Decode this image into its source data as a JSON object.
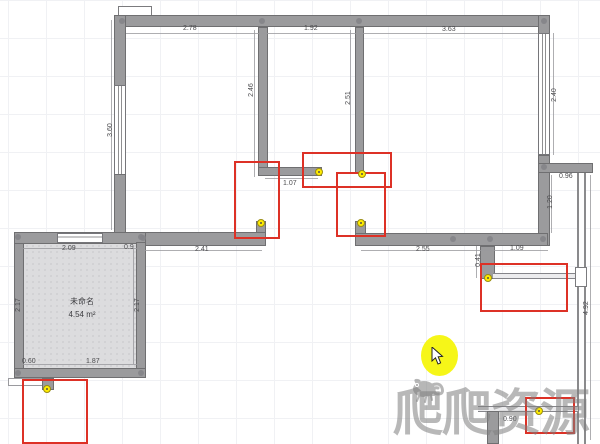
{
  "app": {
    "type": "floorplan-editor"
  },
  "room": {
    "name": "未命名",
    "area": "4.54 m²"
  },
  "watermark": {
    "text": "爬爬资源"
  },
  "colors": {
    "wall": "#9b9b9d",
    "highlight_red": "#dd3126",
    "endpoint_yellow": "#ffec00",
    "cursor_highlight": "#f6f618",
    "watermark_gray": "#7d7d7d"
  },
  "dimensions": [
    {
      "id": "top-left-span",
      "text": "2.78"
    },
    {
      "id": "top-mid-span",
      "text": "1.92"
    },
    {
      "id": "top-right-span",
      "text": "3.63"
    },
    {
      "id": "left-wall-window",
      "text": "3.60"
    },
    {
      "id": "interior-wall-1",
      "text": "2.46"
    },
    {
      "id": "interior-wall-2",
      "text": "2.51"
    },
    {
      "id": "right-wall-window",
      "text": "2.40"
    },
    {
      "id": "right-opening",
      "text": "0.96"
    },
    {
      "id": "right-inner-wall",
      "text": "1.20"
    },
    {
      "id": "right-edge-span",
      "text": "4.92"
    },
    {
      "id": "stub-opening",
      "text": "1.07"
    },
    {
      "id": "bottom-wall-left",
      "text": "2.41"
    },
    {
      "id": "bottom-wall-right",
      "text": "2.55"
    },
    {
      "id": "bottom-wall-end",
      "text": "1.09"
    },
    {
      "id": "down-stub",
      "text": "0.41"
    },
    {
      "id": "room-top-left",
      "text": "2.09"
    },
    {
      "id": "room-top-right",
      "text": "0.9"
    },
    {
      "id": "room-side-left",
      "text": "2.17"
    },
    {
      "id": "room-side-right",
      "text": "2.17"
    },
    {
      "id": "room-bottom-left",
      "text": "0.60"
    },
    {
      "id": "room-bottom-right",
      "text": "1.87"
    },
    {
      "id": "bottom-right-span",
      "text": "0.90"
    }
  ]
}
